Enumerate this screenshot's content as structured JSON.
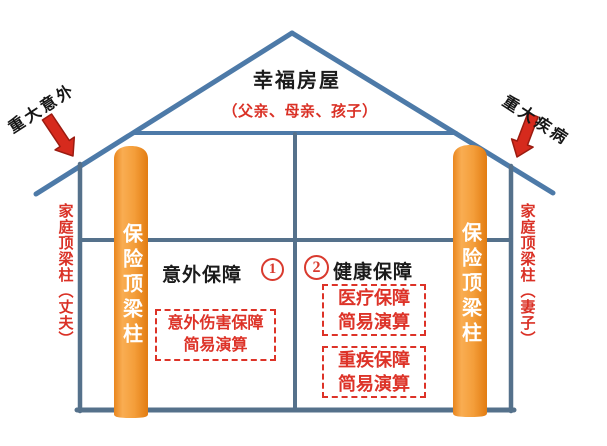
{
  "colors": {
    "roof_line": "#4d7aa8",
    "wall_line": "#55718b",
    "pillar_orange": "#f29b38",
    "accent_red": "#da3126",
    "arrow_red": "#d62a1d",
    "pillar_text_white": "#ffffff",
    "text_black": "#1b1b1b"
  },
  "house": {
    "title": "幸福房屋",
    "subtitle": "（父亲、母亲、孩子）"
  },
  "left": {
    "risk_label": "重大意外",
    "pillar_label": "保险顶梁柱",
    "family_label": "家庭顶梁柱（丈夫）"
  },
  "right": {
    "risk_label": "重大疾病",
    "pillar_label": "保险顶梁柱",
    "family_label": "家庭顶梁柱（妻子）"
  },
  "rooms": {
    "accident": {
      "number": "1",
      "title": "意外保障",
      "boxes": [
        {
          "line1": "意外伤害保障",
          "line2": "简易演算"
        }
      ]
    },
    "health": {
      "number": "2",
      "title": "健康保障",
      "boxes": [
        {
          "line1": "医疗保障",
          "line2": "简易演算"
        },
        {
          "line1": "重疾保障",
          "line2": "简易演算"
        }
      ]
    }
  }
}
